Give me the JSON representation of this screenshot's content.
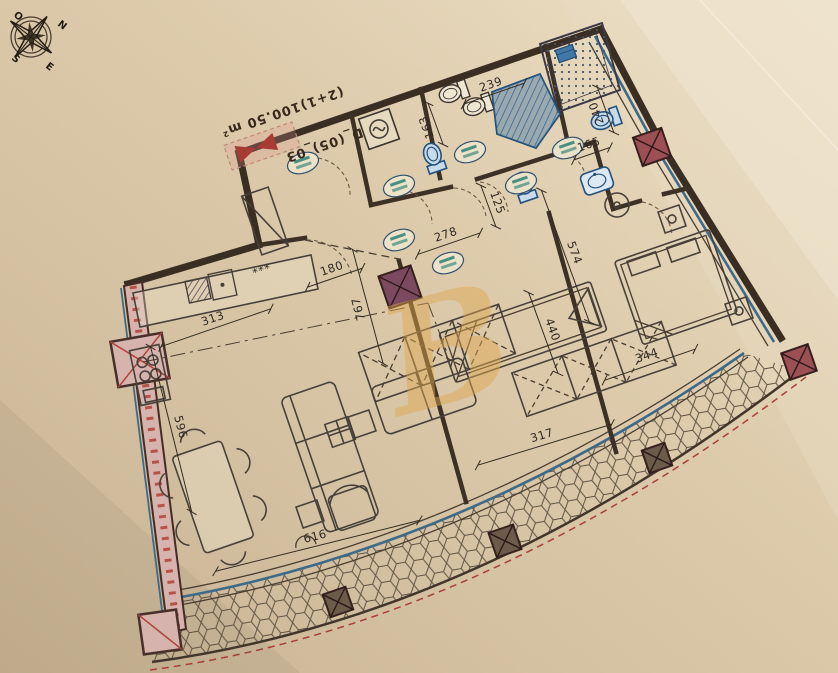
{
  "plan": {
    "unit_title": "D_(05)_03",
    "area_title": "(2+1)100.50 m²",
    "watermark_letter": "B",
    "compass_letters": [
      {
        "t": "O",
        "x": 13,
        "y": 16
      },
      {
        "t": "N",
        "x": 57,
        "y": 25
      },
      {
        "t": "S",
        "x": 11,
        "y": 59
      },
      {
        "t": "E",
        "x": 45,
        "y": 67
      }
    ],
    "dimensions": [
      {
        "text": "239",
        "x": 492,
        "y": 88,
        "rot": -19,
        "len": 64
      },
      {
        "text": "163",
        "x": 430,
        "y": 126,
        "rot": -110,
        "len": 44
      },
      {
        "text": "240",
        "x": 600,
        "y": 112,
        "rot": -110,
        "len": 48
      },
      {
        "text": "165",
        "x": 590,
        "y": 148,
        "rot": -19,
        "len": 38
      },
      {
        "text": "125",
        "x": 494,
        "y": 204,
        "rot": 70,
        "len": 44
      },
      {
        "text": "278",
        "x": 447,
        "y": 238,
        "rot": -19,
        "len": 66
      },
      {
        "text": "180",
        "x": 333,
        "y": 272,
        "rot": -19,
        "len": 58
      },
      {
        "text": "767",
        "x": 362,
        "y": 308,
        "rot": -105,
        "len": 118
      },
      {
        "text": "313",
        "x": 214,
        "y": 322,
        "rot": -19,
        "len": 116
      },
      {
        "text": "596",
        "x": 177,
        "y": 428,
        "rot": 76,
        "len": 170
      },
      {
        "text": "616",
        "x": 316,
        "y": 540,
        "rot": -14,
        "len": 210
      },
      {
        "text": "574",
        "x": 571,
        "y": 254,
        "rot": 70,
        "len": 140
      },
      {
        "text": "440",
        "x": 549,
        "y": 331,
        "rot": 70,
        "len": 86
      },
      {
        "text": "317",
        "x": 543,
        "y": 439,
        "rot": -17,
        "len": 140
      },
      {
        "text": "344",
        "x": 648,
        "y": 359,
        "rot": -19,
        "len": 96
      }
    ],
    "misc_labels": [
      {
        "text": "***",
        "x": 263,
        "y": 274,
        "rot": -19
      }
    ],
    "door_tags": [
      {
        "x": 303,
        "y": 163
      },
      {
        "x": 399,
        "y": 186
      },
      {
        "x": 470,
        "y": 152
      },
      {
        "x": 521,
        "y": 183
      },
      {
        "x": 568,
        "y": 148
      },
      {
        "x": 399,
        "y": 240
      },
      {
        "x": 448,
        "y": 263
      }
    ],
    "columns": [
      {
        "x": 400,
        "y": 287,
        "s": 34,
        "color": "#7b4a5e"
      },
      {
        "x": 652,
        "y": 147,
        "s": 30,
        "color": "#9d5054"
      },
      {
        "x": 799,
        "y": 362,
        "s": 28,
        "color": "#9d5054"
      },
      {
        "x": 505,
        "y": 541,
        "s": 26,
        "color": "#6d5b4a"
      },
      {
        "x": 657,
        "y": 458,
        "s": 24,
        "color": "#6d5b4a"
      },
      {
        "x": 338,
        "y": 602,
        "s": 24,
        "color": "#6d5b4a"
      }
    ],
    "colors": {
      "ink": "#3a2d22",
      "fixture_blue": "#24527e",
      "glazing_blue": "#3d6a88",
      "accent_red": "#b0423a",
      "watermark_gold": "#dfa850",
      "paper": "#d8c6a8"
    }
  }
}
